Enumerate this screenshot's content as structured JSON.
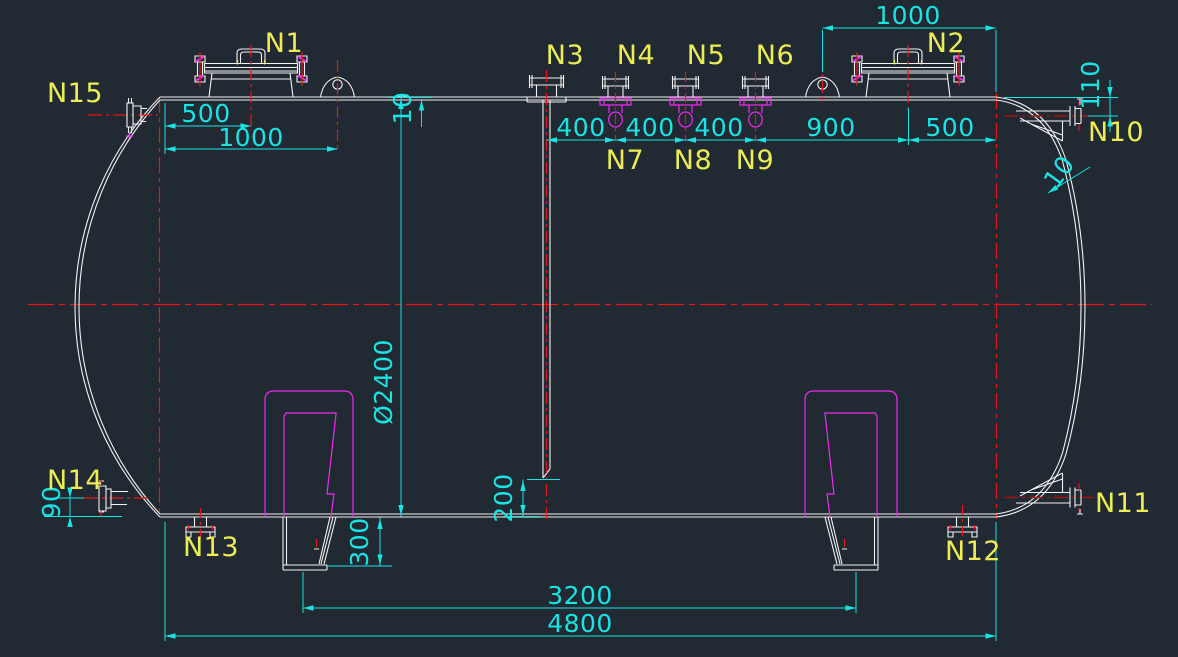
{
  "colors": {
    "background": "#212933",
    "outline_white": "#f2f2f2",
    "dimension_cyan": "#19e3e3",
    "label_yellow": "#ecec55",
    "centerline_red": "#e81616",
    "centerline_dark_red": "#a81212",
    "detail_magenta": "#ee2bee"
  },
  "nozzle_labels": {
    "n1": "N1",
    "n2": "N2",
    "n3": "N3",
    "n4": "N4",
    "n5": "N5",
    "n6": "N6",
    "n7": "N7",
    "n8": "N8",
    "n9": "N9",
    "n10": "N10",
    "n11": "N11",
    "n12": "N12",
    "n13": "N13",
    "n14": "N14",
    "n15": "N15"
  },
  "dimensions": {
    "manhole1_offset": "500",
    "lug1_offset": "1000",
    "lug2_to_head": "1000",
    "nozzle_pitch_1": "400",
    "nozzle_pitch_2": "400",
    "nozzle_pitch_3": "400",
    "n6_to_manhole2": "900",
    "manhole2_to_head": "500",
    "n10_drop": "110",
    "shell_thickness": "10",
    "head_thickness": "10",
    "diameter": "Ø2400",
    "dip_pipe_clearance": "200",
    "saddle_height": "300",
    "n14_offset": "90",
    "saddle_spacing": "3200",
    "overall_length": "4800"
  }
}
